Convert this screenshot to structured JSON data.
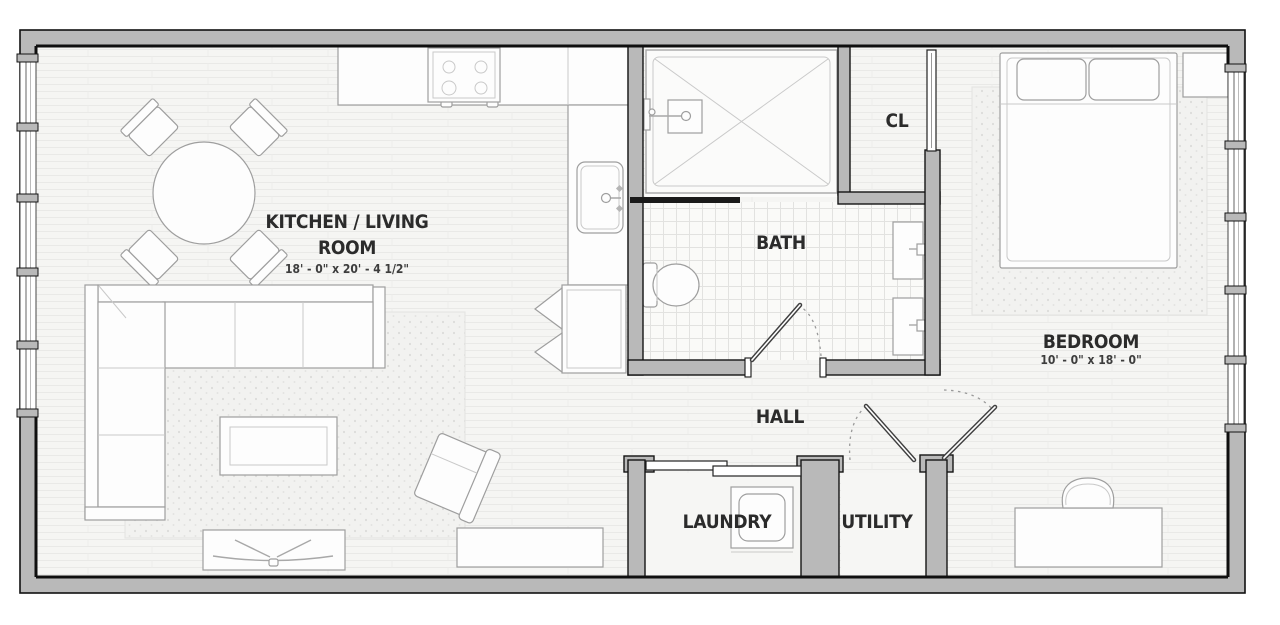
{
  "rooms": {
    "kitchen_living": {
      "name_line1": "KITCHEN / LIVING",
      "name_line2": "ROOM",
      "dims": "18' - 0\" x 20' - 4 1/2\""
    },
    "bath": {
      "name": "BATH"
    },
    "closet": {
      "name": "CL"
    },
    "bedroom": {
      "name": "BEDROOM",
      "dims": "10' - 0\" x 18' - 0\""
    },
    "hall": {
      "name": "HALL"
    },
    "laundry": {
      "name": "LAUNDRY"
    },
    "utility": {
      "name": "UTILITY"
    }
  },
  "colors": {
    "wall_fill": "#b9b9b9",
    "wall_outline": "#141414",
    "floor": "#f5f5f3",
    "plank_line": "#e9e9e7",
    "tile_line": "#e2e2e0",
    "rug_dot": "#dcdcda",
    "furniture_line": "#9e9e9e",
    "label": "#2b2b2b"
  },
  "fixtures": [
    "dining-table",
    "dining-chair",
    "sectional-sofa",
    "coffee-table",
    "living-rug",
    "armchair",
    "tv-console",
    "media-cabinet",
    "kitchen-counter",
    "cooktop",
    "kitchen-sink",
    "refrigerator",
    "shower",
    "shower-head",
    "toilet",
    "vanity-sink",
    "sliding-door",
    "washer-dryer",
    "bed",
    "pillow",
    "bedroom-rug",
    "nightstand",
    "desk",
    "desk-chair",
    "window"
  ]
}
